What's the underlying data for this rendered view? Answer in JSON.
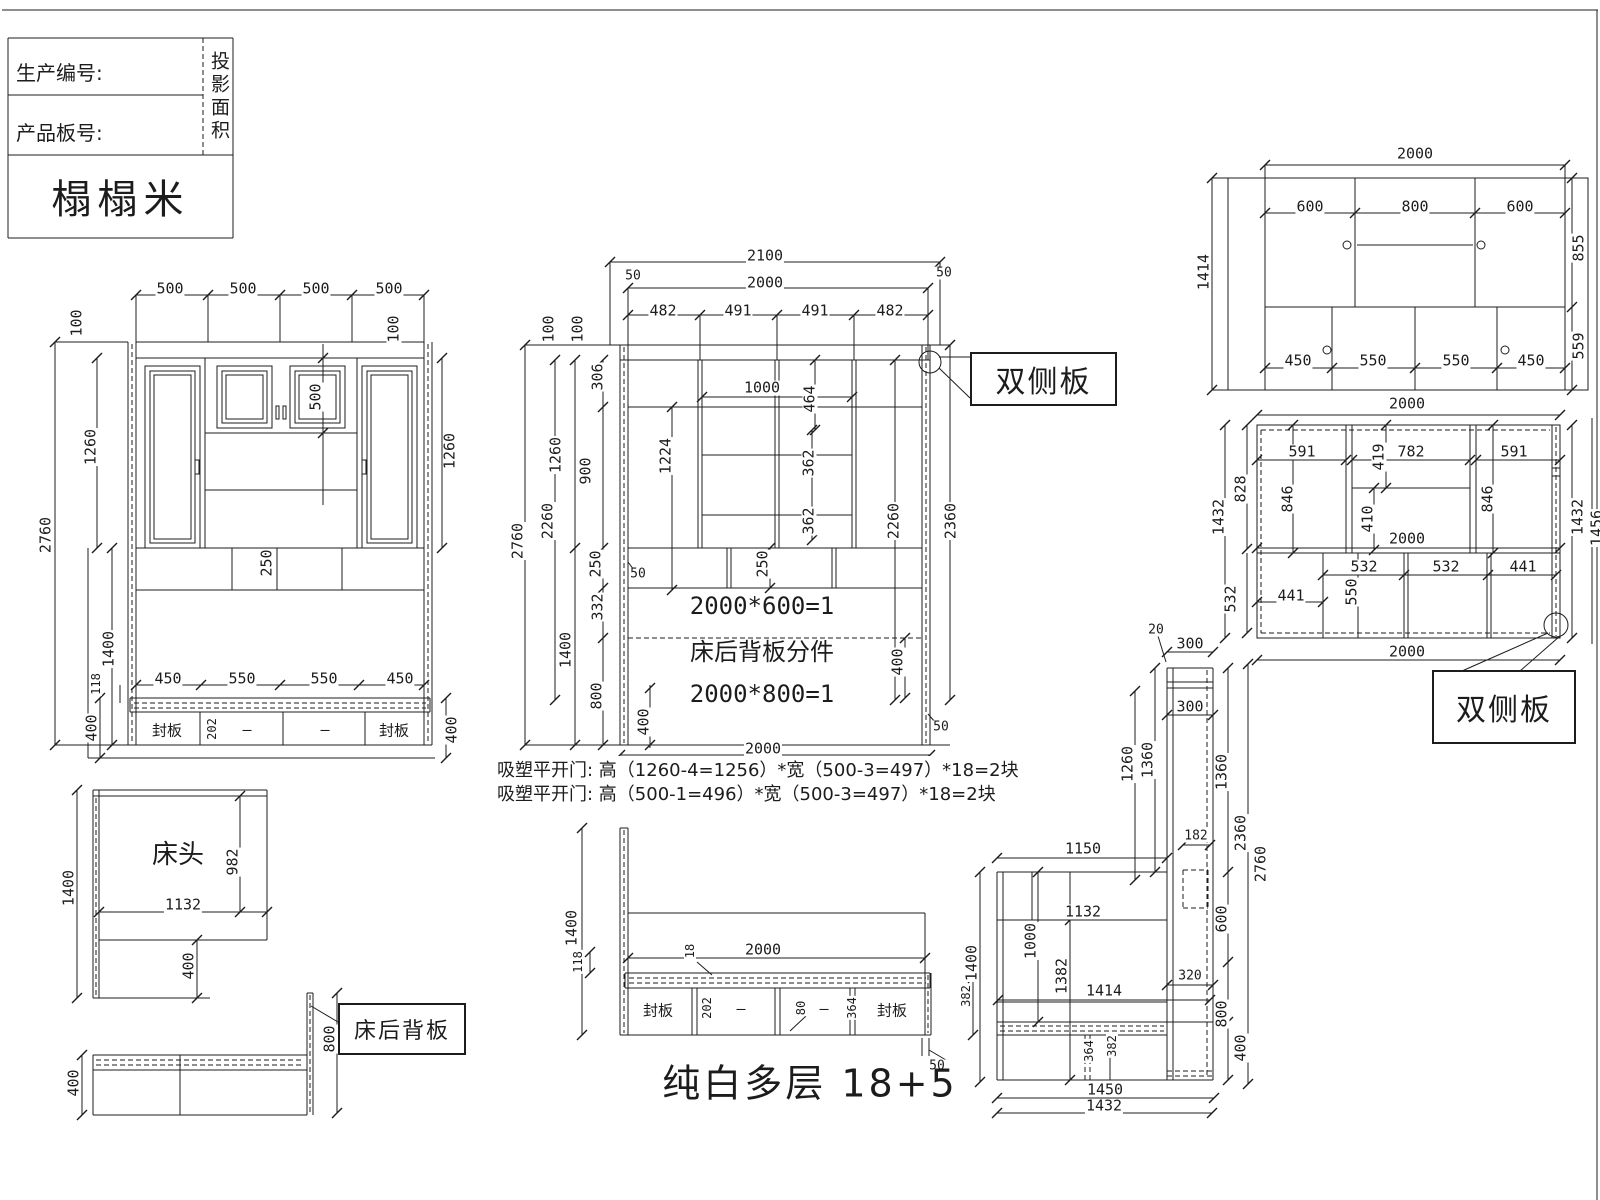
{
  "title_block": {
    "production_no": "生产编号:",
    "product_board_no": "产品板号:",
    "projection_area": "投影面积",
    "product_name": "榻榻米"
  },
  "callouts": {
    "double_side_panel_1": "双侧板",
    "double_side_panel_2": "双侧板",
    "bed_back_panel": "床后背板"
  },
  "notes": {
    "line1": "吸塑平开门: 高（1260-4=1256）*宽（500-3=497）*18=2块",
    "line2": "吸塑平开门: 高（500-1=496）*宽（500-3=497）*18=2块"
  },
  "footer": {
    "material_spec": "纯白多层 18+5"
  },
  "labels": [
    {
      "t": "500",
      "x": 170,
      "y": 289
    },
    {
      "t": "500",
      "x": 243,
      "y": 289
    },
    {
      "t": "500",
      "x": 316,
      "y": 289
    },
    {
      "t": "500",
      "x": 389,
      "y": 289
    },
    {
      "t": "100",
      "x": 77,
      "y": 323,
      "r": 1
    },
    {
      "t": "100",
      "x": 394,
      "y": 329,
      "r": 1
    },
    {
      "t": "1260",
      "x": 91,
      "y": 447,
      "r": 1
    },
    {
      "t": "1260",
      "x": 450,
      "y": 451,
      "r": 1
    },
    {
      "t": "2760",
      "x": 46,
      "y": 535,
      "r": 1
    },
    {
      "t": "500",
      "x": 316,
      "y": 397,
      "r": 1
    },
    {
      "t": "250",
      "x": 267,
      "y": 563,
      "r": 1
    },
    {
      "t": "1400",
      "x": 109,
      "y": 649,
      "r": 1
    },
    {
      "t": "450",
      "x": 168,
      "y": 679
    },
    {
      "t": "550",
      "x": 242,
      "y": 679
    },
    {
      "t": "550",
      "x": 324,
      "y": 679
    },
    {
      "t": "450",
      "x": 400,
      "y": 679
    },
    {
      "t": "118",
      "x": 96,
      "y": 684,
      "r": 1,
      "s": 12
    },
    {
      "t": "400",
      "x": 92,
      "y": 728,
      "r": 1
    },
    {
      "t": "400",
      "x": 452,
      "y": 730,
      "r": 1
    },
    {
      "t": "封板",
      "x": 167,
      "y": 731
    },
    {
      "t": "202",
      "x": 212,
      "y": 729,
      "r": 1,
      "s": 12
    },
    {
      "t": "—",
      "x": 247,
      "y": 730
    },
    {
      "t": "—",
      "x": 325,
      "y": 730
    },
    {
      "t": "封板",
      "x": 394,
      "y": 731
    },
    {
      "t": "2100",
      "x": 765,
      "y": 256
    },
    {
      "t": "50",
      "x": 633,
      "y": 276,
      "s": 13
    },
    {
      "t": "50",
      "x": 944,
      "y": 273,
      "s": 13
    },
    {
      "t": "2000",
      "x": 765,
      "y": 283
    },
    {
      "t": "482",
      "x": 663,
      "y": 311
    },
    {
      "t": "491",
      "x": 738,
      "y": 311
    },
    {
      "t": "491",
      "x": 815,
      "y": 311
    },
    {
      "t": "482",
      "x": 890,
      "y": 311
    },
    {
      "t": "100",
      "x": 549,
      "y": 329,
      "r": 1
    },
    {
      "t": "100",
      "x": 578,
      "y": 329,
      "r": 1
    },
    {
      "t": "306",
      "x": 598,
      "y": 377,
      "r": 1
    },
    {
      "t": "1000",
      "x": 762,
      "y": 388
    },
    {
      "t": "464",
      "x": 810,
      "y": 399,
      "r": 1
    },
    {
      "t": "1260",
      "x": 556,
      "y": 455,
      "r": 1
    },
    {
      "t": "900",
      "x": 586,
      "y": 471,
      "r": 1
    },
    {
      "t": "1224",
      "x": 666,
      "y": 456,
      "r": 1
    },
    {
      "t": "362",
      "x": 809,
      "y": 463,
      "r": 1
    },
    {
      "t": "362",
      "x": 809,
      "y": 521,
      "r": 1
    },
    {
      "t": "2760",
      "x": 518,
      "y": 541,
      "r": 1
    },
    {
      "t": "2260",
      "x": 548,
      "y": 521,
      "r": 1
    },
    {
      "t": "250",
      "x": 596,
      "y": 564,
      "r": 1
    },
    {
      "t": "50",
      "x": 638,
      "y": 574,
      "s": 13
    },
    {
      "t": "250",
      "x": 763,
      "y": 564,
      "r": 1
    },
    {
      "t": "332",
      "x": 598,
      "y": 607,
      "r": 1
    },
    {
      "t": "1400",
      "x": 566,
      "y": 650,
      "r": 1
    },
    {
      "t": "800",
      "x": 597,
      "y": 696,
      "r": 1
    },
    {
      "t": "400",
      "x": 644,
      "y": 722,
      "r": 1
    },
    {
      "t": "2000*600=1",
      "x": 762,
      "y": 606,
      "s": 24
    },
    {
      "t": "床后背板分件",
      "x": 762,
      "y": 652,
      "s": 24
    },
    {
      "t": "2000*800=1",
      "x": 762,
      "y": 694,
      "s": 24
    },
    {
      "t": "2000",
      "x": 763,
      "y": 749
    },
    {
      "t": "2260",
      "x": 894,
      "y": 521,
      "r": 1
    },
    {
      "t": "2360",
      "x": 951,
      "y": 521,
      "r": 1
    },
    {
      "t": "400",
      "x": 898,
      "y": 662,
      "r": 1
    },
    {
      "t": "50",
      "x": 941,
      "y": 727,
      "s": 13
    },
    {
      "t": "2000",
      "x": 1415,
      "y": 154
    },
    {
      "t": "600",
      "x": 1310,
      "y": 207
    },
    {
      "t": "800",
      "x": 1415,
      "y": 207
    },
    {
      "t": "600",
      "x": 1520,
      "y": 207
    },
    {
      "t": "1414",
      "x": 1204,
      "y": 272,
      "r": 1
    },
    {
      "t": "855",
      "x": 1579,
      "y": 248,
      "r": 1
    },
    {
      "t": "559",
      "x": 1579,
      "y": 346,
      "r": 1
    },
    {
      "t": "450",
      "x": 1298,
      "y": 361
    },
    {
      "t": "550",
      "x": 1373,
      "y": 361
    },
    {
      "t": "550",
      "x": 1456,
      "y": 361
    },
    {
      "t": "450",
      "x": 1531,
      "y": 361
    },
    {
      "t": "2000",
      "x": 1407,
      "y": 404
    },
    {
      "t": "591",
      "x": 1302,
      "y": 452
    },
    {
      "t": "419",
      "x": 1379,
      "y": 457,
      "r": 1
    },
    {
      "t": "782",
      "x": 1411,
      "y": 452
    },
    {
      "t": "591",
      "x": 1514,
      "y": 452
    },
    {
      "t": "846",
      "x": 1288,
      "y": 499,
      "r": 1
    },
    {
      "t": "846",
      "x": 1488,
      "y": 499,
      "r": 1
    },
    {
      "t": "410",
      "x": 1368,
      "y": 519,
      "r": 1
    },
    {
      "t": "2000",
      "x": 1407,
      "y": 539
    },
    {
      "t": "828",
      "x": 1241,
      "y": 489,
      "r": 1
    },
    {
      "t": "1432",
      "x": 1219,
      "y": 517,
      "r": 1
    },
    {
      "t": "532",
      "x": 1231,
      "y": 599,
      "r": 1
    },
    {
      "t": "441",
      "x": 1291,
      "y": 596
    },
    {
      "t": "550",
      "x": 1352,
      "y": 592,
      "r": 1
    },
    {
      "t": "532",
      "x": 1364,
      "y": 567
    },
    {
      "t": "532",
      "x": 1446,
      "y": 567
    },
    {
      "t": "441",
      "x": 1523,
      "y": 567
    },
    {
      "t": "1432",
      "x": 1578,
      "y": 517,
      "r": 1
    },
    {
      "t": "1456",
      "x": 1597,
      "y": 528,
      "r": 1
    },
    {
      "t": "2000",
      "x": 1407,
      "y": 652
    },
    {
      "t": "20",
      "x": 1156,
      "y": 630,
      "s": 13
    },
    {
      "t": "300",
      "x": 1190,
      "y": 644
    },
    {
      "t": "300",
      "x": 1190,
      "y": 707
    },
    {
      "t": "1260",
      "x": 1128,
      "y": 764,
      "r": 1
    },
    {
      "t": "1360",
      "x": 1148,
      "y": 760,
      "r": 1
    },
    {
      "t": "1360",
      "x": 1222,
      "y": 772,
      "r": 1
    },
    {
      "t": "2360",
      "x": 1241,
      "y": 833,
      "r": 1
    },
    {
      "t": "2760",
      "x": 1261,
      "y": 864,
      "r": 1
    },
    {
      "t": "182",
      "x": 1196,
      "y": 836,
      "s": 13
    },
    {
      "t": "600",
      "x": 1222,
      "y": 919,
      "r": 1
    },
    {
      "t": "320",
      "x": 1190,
      "y": 976,
      "s": 13
    },
    {
      "t": "800",
      "x": 1222,
      "y": 1014,
      "r": 1
    },
    {
      "t": "400",
      "x": 1241,
      "y": 1048,
      "r": 1
    },
    {
      "t": "1150",
      "x": 1083,
      "y": 849
    },
    {
      "t": "1132",
      "x": 1083,
      "y": 912
    },
    {
      "t": "1000",
      "x": 1031,
      "y": 941,
      "r": 1
    },
    {
      "t": "1382",
      "x": 1062,
      "y": 976,
      "r": 1
    },
    {
      "t": "1400",
      "x": 972,
      "y": 963,
      "r": 1
    },
    {
      "t": "1414",
      "x": 1104,
      "y": 991
    },
    {
      "t": "364",
      "x": 1089,
      "y": 1051,
      "r": 1,
      "s": 12
    },
    {
      "t": "382",
      "x": 1112,
      "y": 1046,
      "r": 1,
      "s": 12
    },
    {
      "t": "1450",
      "x": 1105,
      "y": 1090
    },
    {
      "t": "1432",
      "x": 1104,
      "y": 1106
    },
    {
      "t": "1400",
      "x": 572,
      "y": 928,
      "r": 1
    },
    {
      "t": "118",
      "x": 578,
      "y": 962,
      "r": 1,
      "s": 12
    },
    {
      "t": "18",
      "x": 690,
      "y": 951,
      "r": 1,
      "s": 12
    },
    {
      "t": "2000",
      "x": 763,
      "y": 950
    },
    {
      "t": "封板",
      "x": 658,
      "y": 1011
    },
    {
      "t": "202",
      "x": 707,
      "y": 1008,
      "r": 1,
      "s": 12
    },
    {
      "t": "—",
      "x": 741,
      "y": 1009
    },
    {
      "t": "80",
      "x": 801,
      "y": 1008,
      "r": 1,
      "s": 12
    },
    {
      "t": "—",
      "x": 824,
      "y": 1009
    },
    {
      "t": "364",
      "x": 852,
      "y": 1008,
      "r": 1,
      "s": 12
    },
    {
      "t": "封板",
      "x": 892,
      "y": 1011
    },
    {
      "t": "382",
      "x": 966,
      "y": 996,
      "r": 1,
      "s": 12
    },
    {
      "t": "50",
      "x": 937,
      "y": 1066,
      "s": 13
    },
    {
      "t": "床头",
      "x": 178,
      "y": 855,
      "s": 26
    },
    {
      "t": "982",
      "x": 233,
      "y": 862,
      "r": 1
    },
    {
      "t": "1132",
      "x": 183,
      "y": 905
    },
    {
      "t": "400",
      "x": 189,
      "y": 966,
      "r": 1
    },
    {
      "t": "1400",
      "x": 69,
      "y": 888,
      "r": 1
    },
    {
      "t": "400",
      "x": 74,
      "y": 1083,
      "r": 1
    },
    {
      "t": "800",
      "x": 330,
      "y": 1039,
      "r": 1
    }
  ]
}
